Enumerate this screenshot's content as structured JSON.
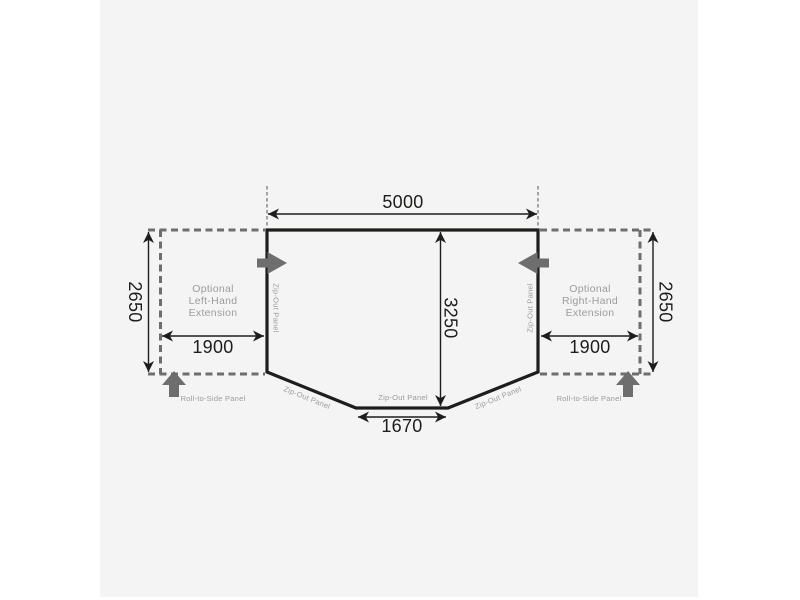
{
  "colors": {
    "ink": "#1d1d1b",
    "dashed": "#6f6e6e",
    "arrow": "#6f6e6e",
    "label": "#9c9c9b",
    "panel": "#f4f4f4",
    "page": "#ffffff"
  },
  "dims": {
    "top_width": "5000",
    "depth": "3250",
    "front_panel_width": "1670",
    "left_extension_width": "1900",
    "right_extension_width": "1900",
    "left_extension_depth": "2650",
    "right_extension_depth": "2650"
  },
  "labels": {
    "left_extension": {
      "line1": "Optional",
      "line2": "Left-Hand",
      "line3": "Extension"
    },
    "right_extension": {
      "line1": "Optional",
      "line2": "Right-Hand",
      "line3": "Extension"
    },
    "roll_to_side_left": "Roll-to-Side Panel",
    "roll_to_side_right": "Roll-to-Side Panel",
    "zip_out_left_wall": "Zip-Out Panel",
    "zip_out_right_wall": "Zip-Out Panel",
    "zip_out_front_left": "Zip-Out Panel",
    "zip_out_front_center": "Zip-Out Panel",
    "zip_out_front_right": "Zip-Out Panel"
  }
}
